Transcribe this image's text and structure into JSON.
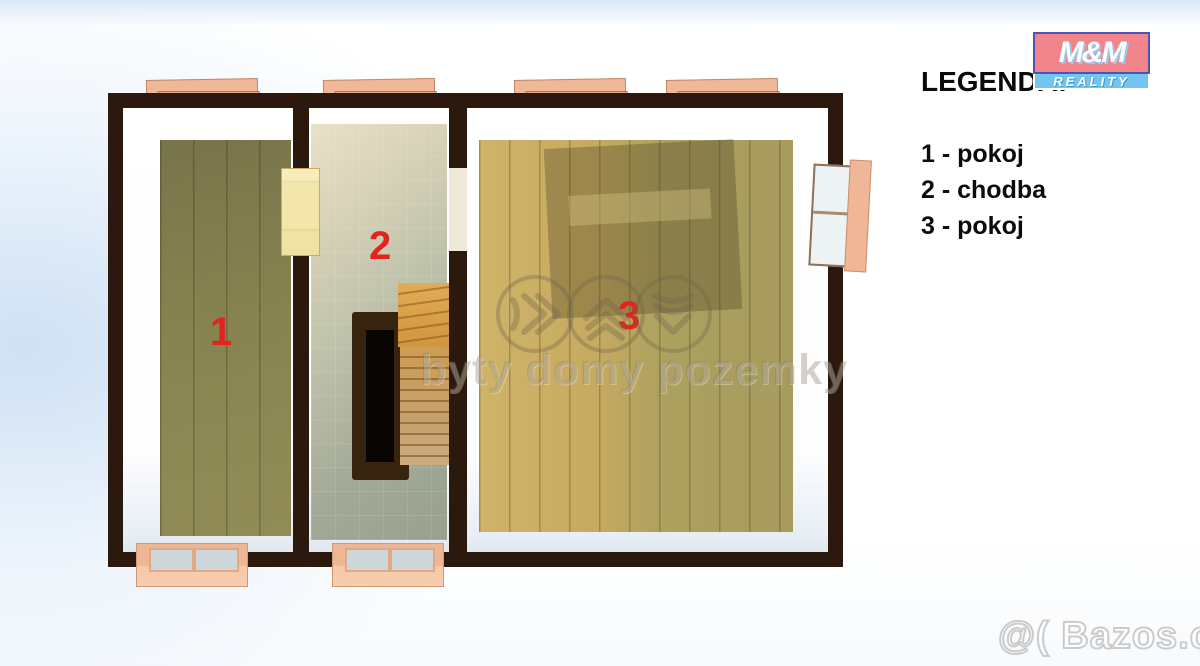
{
  "legend": {
    "title": "LEGENDA:",
    "items": [
      {
        "label": "1 - pokoj"
      },
      {
        "label": "2 - chodba"
      },
      {
        "label": "3 - pokoj"
      }
    ]
  },
  "logo": {
    "line1": "M&M",
    "line2": "REALITY"
  },
  "floorplan": {
    "room_labels": [
      {
        "number": "1"
      },
      {
        "number": "2"
      },
      {
        "number": "3"
      }
    ],
    "label_color": "#e2231e",
    "wall_color": "#2b190e",
    "window_frame_color": "#efb697",
    "room1_floor_color": "#878350",
    "room2_floor_color": "#c2c1aa",
    "room3_floor_color": "#bda861"
  },
  "watermarks": {
    "center_text": "byty domy pozemky",
    "corner_text": "@( Bazos.cz",
    "icons": [
      "chevrons-right-icon",
      "chevrons-up-icon",
      "chevrons-down-icon"
    ]
  },
  "colors": {
    "logo_top_bg": "#f2858c",
    "logo_bottom_bg": "#72c5ee",
    "background_tint": "#d8e6f4"
  }
}
